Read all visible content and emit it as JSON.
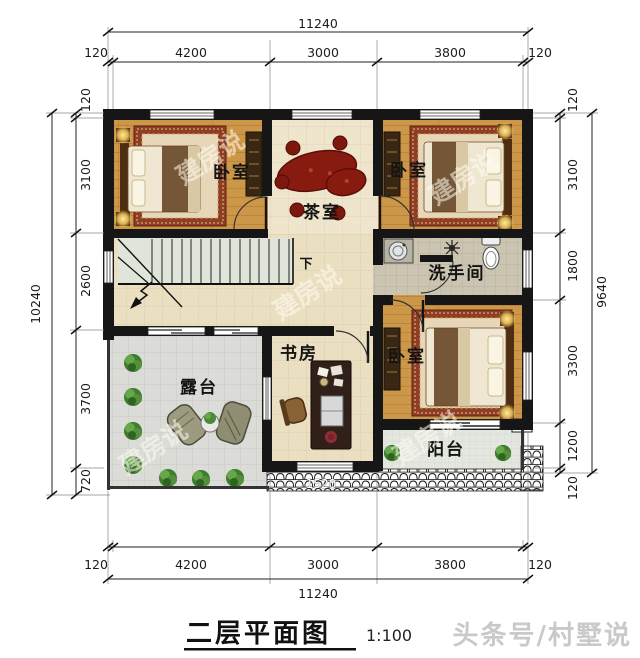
{
  "drawing": {
    "title": "二层平面图",
    "scale_label": "1:100",
    "footer_watermark": "头条号/村墅说",
    "plan_watermark": "建房说"
  },
  "rooms": {
    "bedroom_top_left": "卧室",
    "tea_room": "茶室",
    "bedroom_top_right": "卧室",
    "bathroom": "洗手间",
    "study": "书房",
    "bedroom_bottom_right": "卧室",
    "terrace": "露台",
    "balcony": "阳台",
    "stairs_direction": "下"
  },
  "dimensions": {
    "top": {
      "overall": "11240",
      "segments": [
        "120",
        "4200",
        "3000",
        "3800",
        "120"
      ]
    },
    "bottom": {
      "overall": "11240",
      "segments": [
        "120",
        "4200",
        "3000",
        "3800",
        "120"
      ]
    },
    "left": {
      "overall": "10240",
      "segments": [
        "120",
        "3100",
        "2600",
        "3700",
        "720"
      ]
    },
    "right": {
      "overall": "9640",
      "segments": [
        "120",
        "3100",
        "1800",
        "3300",
        "1200",
        "120"
      ]
    },
    "balcony_rail": "1520"
  },
  "colors": {
    "wall": "#161616",
    "wood_floor": "#cd9749",
    "rug_border": "#8f3d26",
    "tea_table": "#871b10",
    "accent_glow": "#f3c95e"
  }
}
